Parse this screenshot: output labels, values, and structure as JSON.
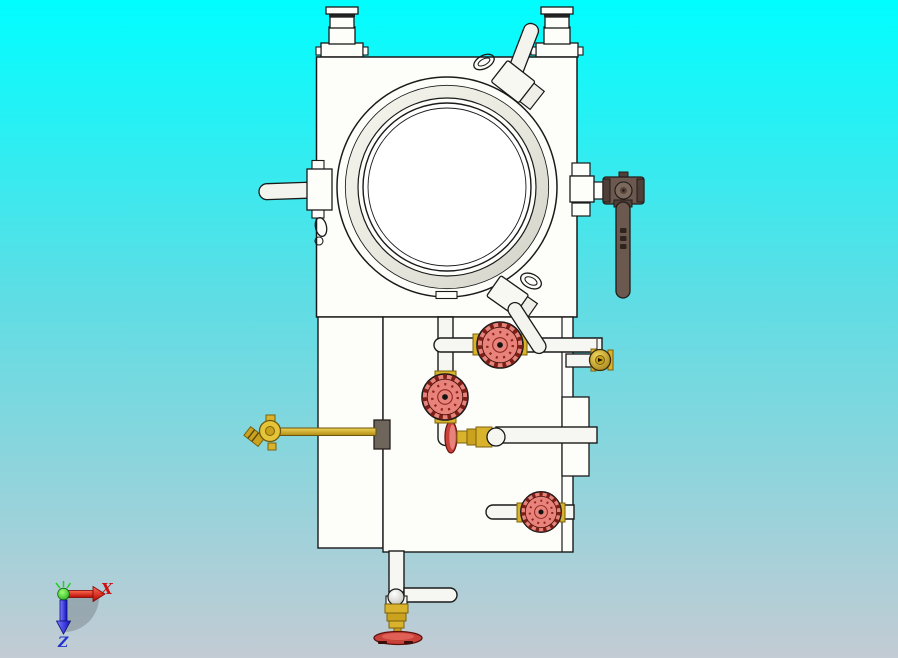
{
  "triad": {
    "x_label": "X",
    "z_label": "Z"
  },
  "colors": {
    "background_top": "#00feff",
    "background_mid": "#5eddE4",
    "background_bottom": "#c3cbd4",
    "model_outline": "#1a1a1a",
    "model_fill": "#fdfdfa",
    "pipe_fill": "#f6f6f2",
    "handwheel_face": "#e8837b",
    "handwheel_rim": "#8f241d",
    "wheel_red": "#c8423a",
    "brass": "#d9b32c",
    "brass_deep": "#caa21e",
    "brass_dark": "#7a620e",
    "ball_valve_brown": "#6b584e",
    "ball_valve_dark": "#4e3f38",
    "axis_x_color": "#cc1111",
    "axis_z_color": "#2233cc",
    "origin_green": "#22cc22"
  }
}
